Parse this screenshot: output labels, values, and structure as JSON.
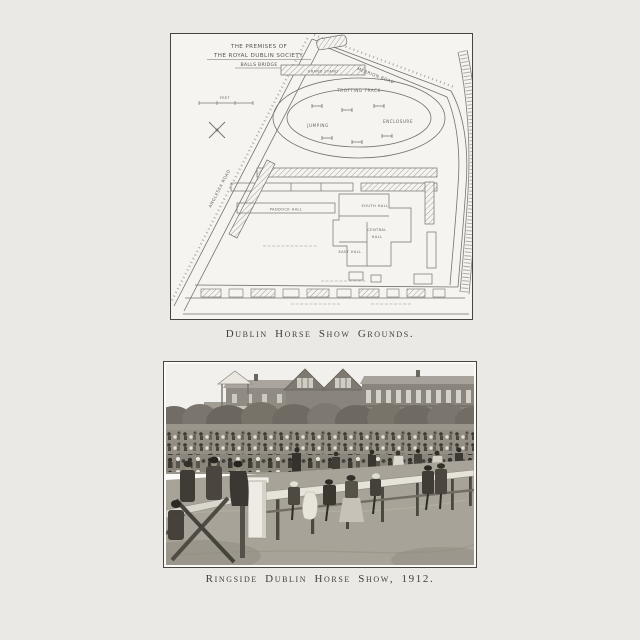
{
  "page": {
    "background_color": "#eae9e5",
    "ink_color": "#47453f"
  },
  "map_figure": {
    "caption": "Dublin Horse Show Grounds.",
    "title_line1": "THE PREMISES OF",
    "title_line2": "THE ROYAL DUBLIN SOCIETY.",
    "title_line3": "BALLS BRIDGE",
    "labels": {
      "grand_stand": "GRAND STAND",
      "trotting_track": "TROTTING TRACK",
      "jumping": "JUMPING",
      "enclosure": "ENCLOSURE",
      "paddock_hall": "PADDOCK HALL",
      "south_hall": "SOUTH HALL",
      "central_hall_line1": "CENTRAL",
      "central_hall_line2": "HALL",
      "east_hall": "EAST HALL",
      "anglesea_road": "ANGLESEA ROAD",
      "merrion_road": "MERRION ROAD",
      "scale_feet": "FEET"
    }
  },
  "photo_figure": {
    "caption": "Ringside Dublin Horse Show, 1912."
  }
}
